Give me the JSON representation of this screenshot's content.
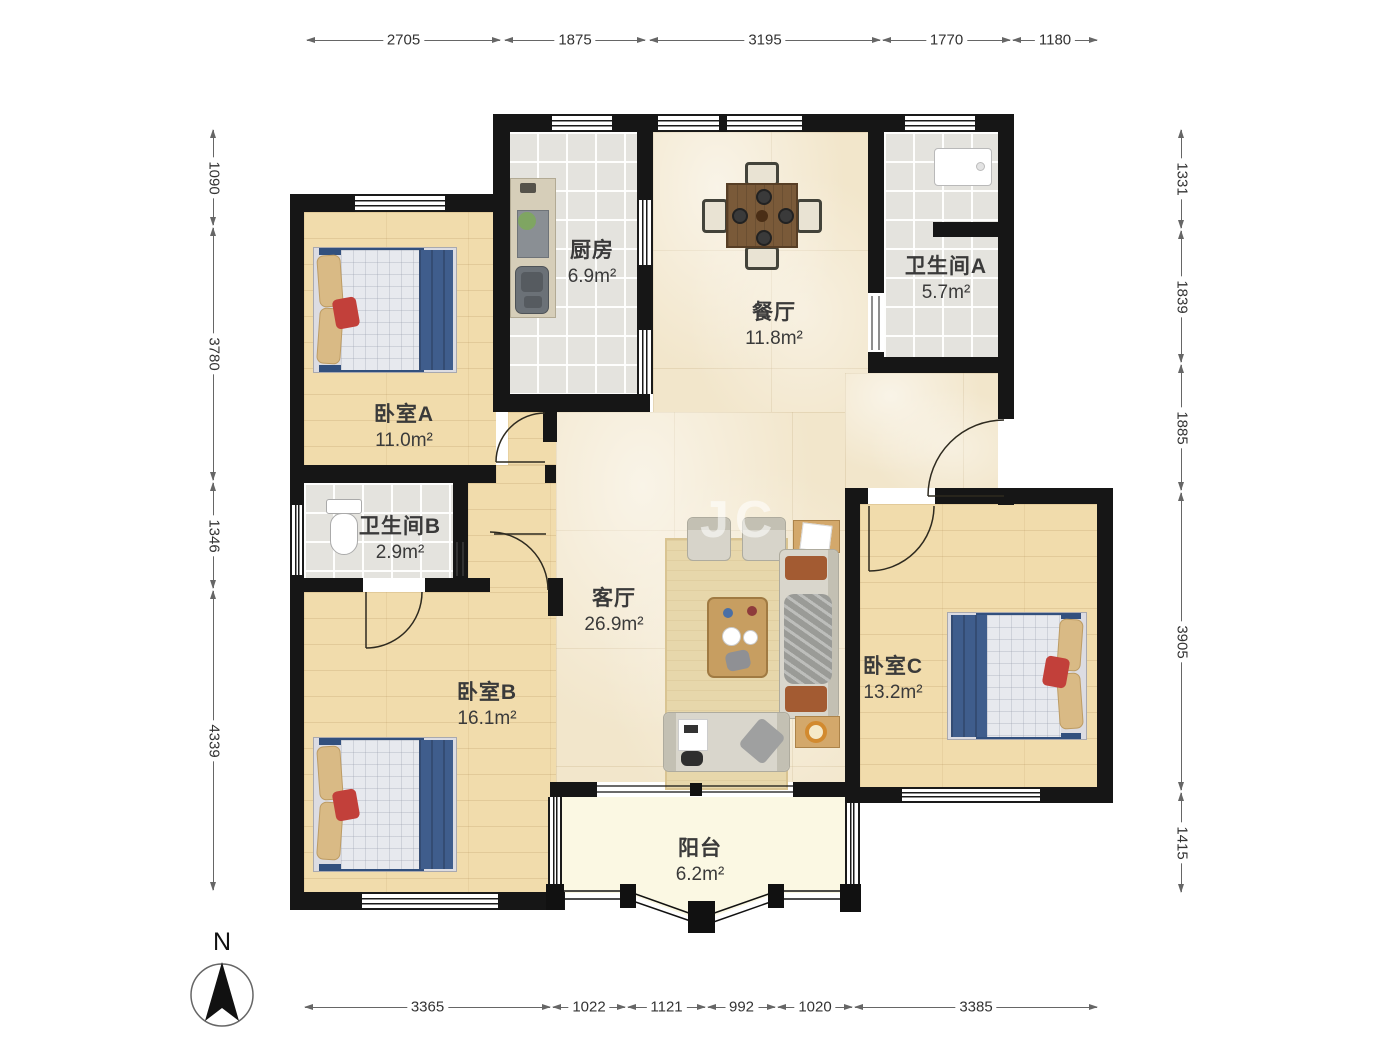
{
  "rooms": {
    "kitchen": {
      "name": "厨房",
      "area": "6.9m²"
    },
    "dining": {
      "name": "餐厅",
      "area": "11.8m²"
    },
    "bathA": {
      "name": "卫生间A",
      "area": "5.7m²"
    },
    "bedroomA": {
      "name": "卧室A",
      "area": "11.0m²"
    },
    "bathB": {
      "name": "卫生间B",
      "area": "2.9m²"
    },
    "living": {
      "name": "客厅",
      "area": "26.9m²"
    },
    "bedroomB": {
      "name": "卧室B",
      "area": "16.1m²"
    },
    "bedroomC": {
      "name": "卧室C",
      "area": "13.2m²"
    },
    "balcony": {
      "name": "阳台",
      "area": "6.2m²"
    }
  },
  "dims": {
    "top": [
      "2705",
      "1875",
      "3195",
      "1770",
      "1180"
    ],
    "bottom": [
      "3365",
      "1022",
      "1121",
      "992",
      "1020",
      "3385"
    ],
    "left": [
      "1090",
      "3780",
      "1346",
      "4339"
    ],
    "right": [
      "1331",
      "1839",
      "1885",
      "3905",
      "1415"
    ]
  },
  "compass": {
    "label": "N"
  },
  "watermark": {
    "text": "JC"
  },
  "colors": {
    "wall": "#161616",
    "wood_floor": "#F1DCAC",
    "tile_floor": "#E4E3DE",
    "marble_floor": "#F2E6CB",
    "balcony_floor": "#FBF8E3",
    "bed_blanket_blue": "#3F5D8C",
    "accent_red": "#C2403A"
  }
}
